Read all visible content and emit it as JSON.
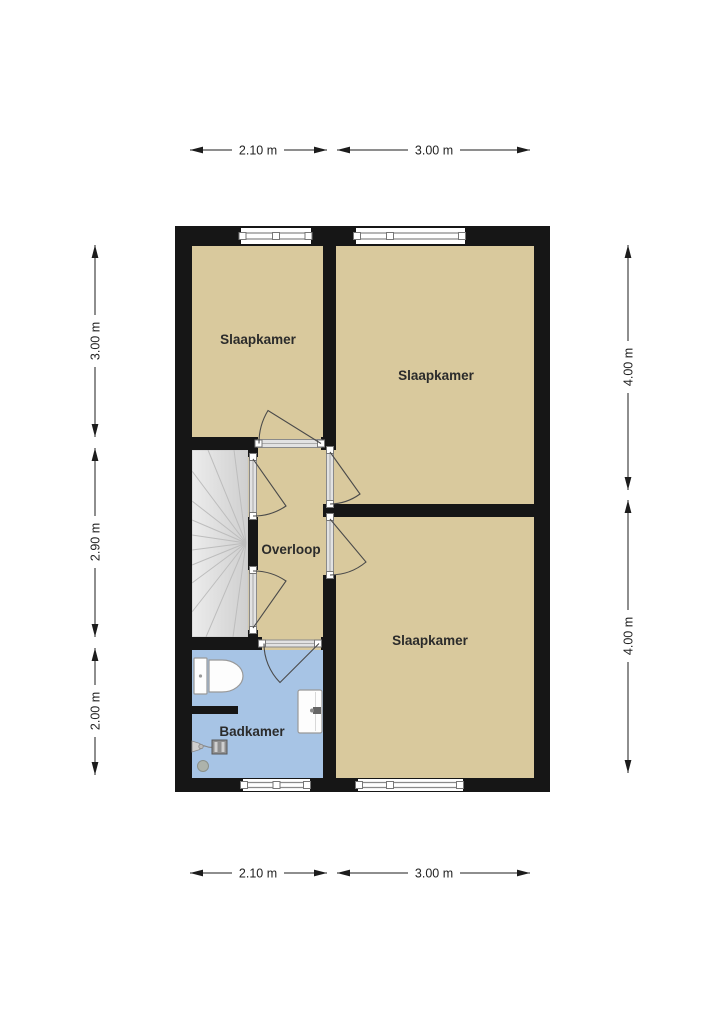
{
  "floorplan": {
    "rooms": [
      {
        "id": "slaapkamer-top-left",
        "label": "Slaapkamer"
      },
      {
        "id": "slaapkamer-top-right",
        "label": "Slaapkamer"
      },
      {
        "id": "slaapkamer-bottom-right",
        "label": "Slaapkamer"
      },
      {
        "id": "overloop",
        "label": "Overloop"
      },
      {
        "id": "badkamer",
        "label": "Badkamer"
      }
    ],
    "dimensions": {
      "top": [
        "2.10 m",
        "3.00 m"
      ],
      "bottom": [
        "2.10 m",
        "3.00 m"
      ],
      "left": [
        "3.00 m",
        "2.90 m",
        "2.00 m"
      ],
      "right": [
        "4.00 m",
        "4.00 m"
      ]
    },
    "fixtures": [
      "staircase",
      "toilet",
      "washbasin",
      "shower-mixer",
      "shower-head",
      "shower-drain"
    ],
    "colors": {
      "wall": "#161616",
      "room_fill": "#d9c99d",
      "bathroom_fill": "#a7c4e5",
      "stairs_fill": "#dcdcdc",
      "dim_text": "#222222"
    }
  }
}
